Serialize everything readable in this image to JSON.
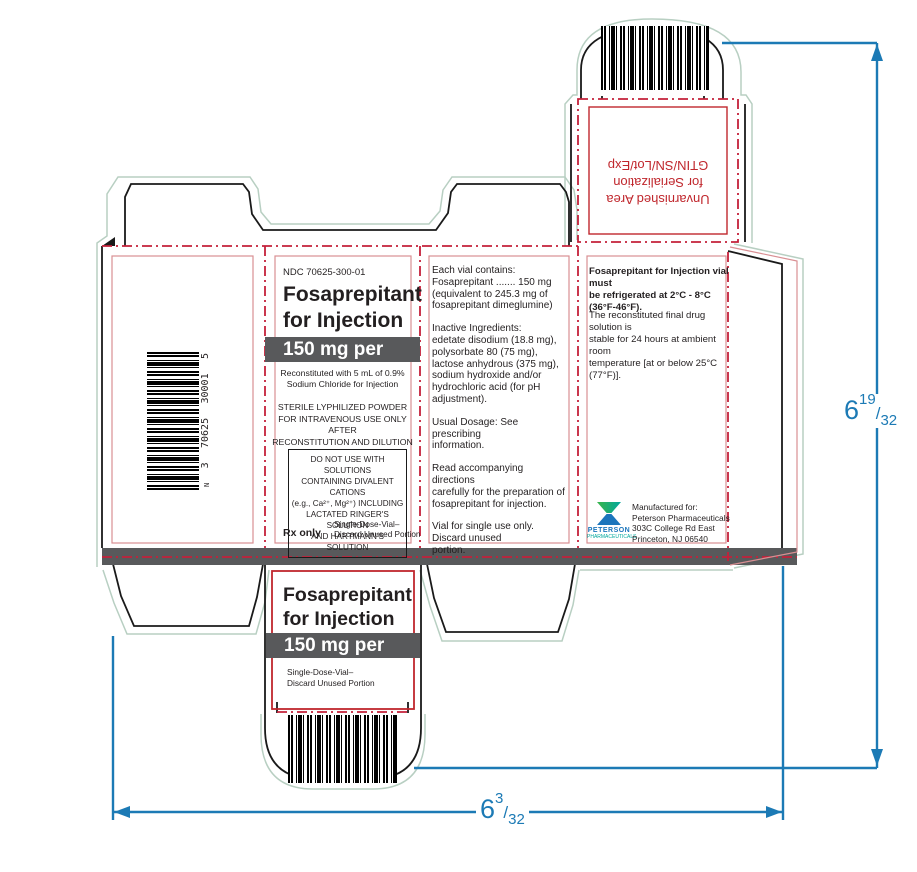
{
  "colors": {
    "ink": "#231f20",
    "red": "#c0272d",
    "red-line": "#c4203a",
    "pink": "#d98f93",
    "blue": "#1c7ab5",
    "gray": "#58595b",
    "green": "#b8cfc2",
    "logo-blue": "#1b75bc",
    "logo-teal": "#00a79d",
    "logo-green": "#3ab54a"
  },
  "front_panel": {
    "ndc": "NDC 70625-300-01",
    "title": "Fosaprepitant\nfor Injection",
    "strength": "150 mg per vial",
    "reconstitution": "Reconstituted with 5 mL of 0.9%\nSodium Chloride for Injection",
    "sterile_statement": "STERILE LYPHILIZED POWDER\nFOR INTRAVENOUS USE ONLY AFTER\nRECONSTITUTION AND DILUTION",
    "warning_box": "DO NOT USE WITH SOLUTIONS\nCONTAINING DIVALENT CATIONS\n(e.g., Ca²⁺, Mg²⁺) INCLUDING\nLACTATED RINGER'S SOLUTION\nAND HARTMANN'S SOLUTION",
    "rx_only": "Rx only",
    "single_dose": "Single-Dose-Vial–\nDiscard Unused Portion",
    "barcode_number": {
      "prefix": "N",
      "g1": "3",
      "g2": "70625",
      "g3": "30001",
      "g4": "5"
    }
  },
  "ingredients_panel": {
    "paragraphs": [
      "Each vial contains:\nFosaprepitant ....... 150 mg\n(equivalent to 245.3 mg of\nfosaprepitant dimeglumine)",
      "Inactive Ingredients:\nedetate disodium (18.8 mg),\npolysorbate 80 (75 mg),\nlactose anhydrous (375 mg),\nsodium hydroxide and/or\nhydrochloric acid (for pH adjustment).",
      "Usual Dosage: See prescribing\ninformation.",
      "Read accompanying directions\ncarefully for the preparation of\nfosaprepitant for injection.",
      "Vial for single use only. Discard unused\nportion."
    ]
  },
  "storage_panel": {
    "refrigeration": "Fosaprepitant for Injection vial must\nbe refrigerated at 2°C - 8°C\n(36°F-46°F).",
    "stability": "The reconstituted final drug solution is\nstable for 24 hours at ambient room\ntemperature [at or below 25°C (77°F)].",
    "logo_name": "PETERSON",
    "logo_subtitle": "PHARMACEUTICALS",
    "manufactured_for": "Manufactured for:\nPeterson Pharmaceuticals\n303C College Rd East\nPrinceton, NJ 06540"
  },
  "serialization_flap": {
    "text": "Unvarnished Area\nfor Serialization\nGTIN/SN/Lot/Exp"
  },
  "bottom_panel": {
    "title": "Fosaprepitant\nfor Injection",
    "strength": "150 mg per vial",
    "single_dose": "Single-Dose-Vial–\nDiscard Unused Portion"
  },
  "dimensions": {
    "height": {
      "whole": "6",
      "numerator": "19",
      "slash": "/",
      "denominator": "32"
    },
    "width": {
      "whole": "6",
      "numerator": "3",
      "slash": "/",
      "denominator": "32"
    }
  }
}
